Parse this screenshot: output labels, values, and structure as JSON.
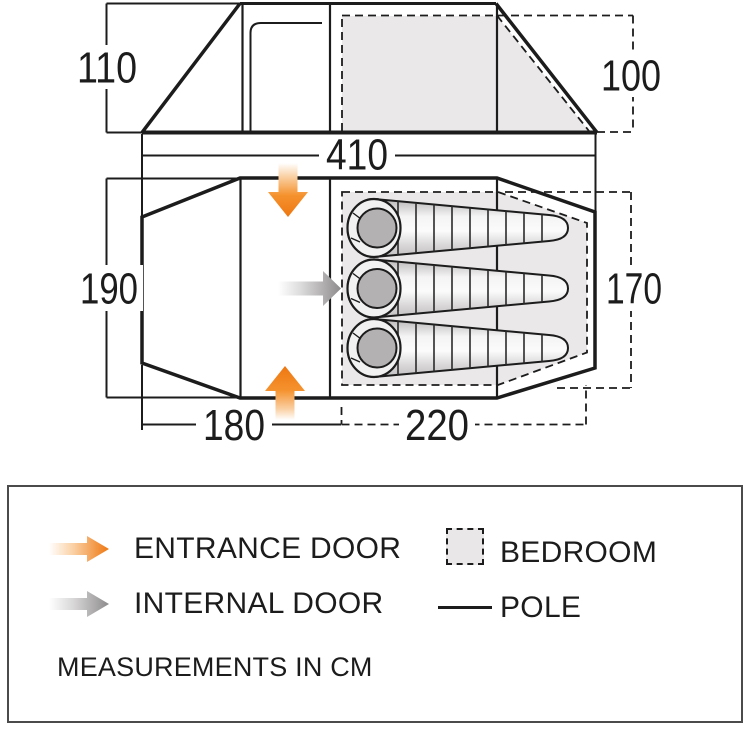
{
  "diagram": {
    "side_view": {
      "height_outer_cm": "110",
      "height_inner_cm": "100",
      "length_cm": "410"
    },
    "floor_plan": {
      "width_outer_cm": "190",
      "width_inner_cm": "170",
      "porch_length_cm": "180",
      "bedroom_length_cm": "220",
      "sleeping_bag_count": 3
    }
  },
  "legend": {
    "entrance_door_label": "ENTRANCE DOOR",
    "internal_door_label": "INTERNAL DOOR",
    "bedroom_label": "BEDROOM",
    "pole_label": "POLE",
    "note": "MEASUREMENTS IN CM"
  },
  "colors": {
    "entrance_orange": "#ee7711",
    "internal_gray": "#8d8b8c",
    "bedroom_fill": "#eae8e9",
    "line": "#1c1c1c"
  }
}
